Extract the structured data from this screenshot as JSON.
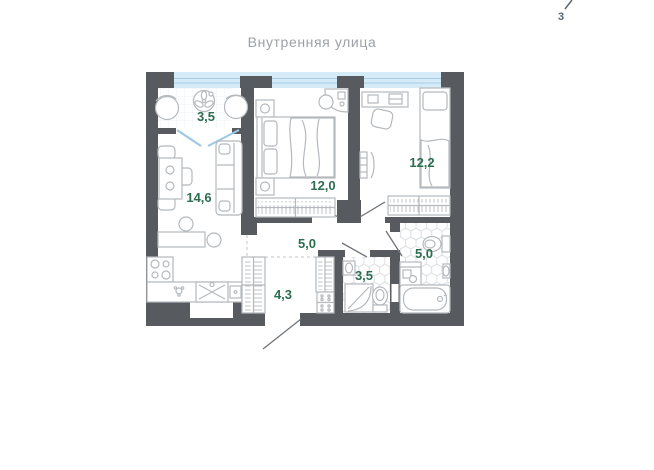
{
  "header": {
    "street_label": "Внутренняя улица"
  },
  "compass": {
    "north_label": "3"
  },
  "rooms": {
    "loggia": "3,5",
    "living_kitchen": "14,6",
    "bedroom_1": "12,0",
    "bedroom_2": "12,2",
    "corridor": "5,0",
    "bathroom_small": "3,5",
    "bathroom_large": "5,0",
    "hallway": "4,3"
  },
  "colors": {
    "wall": "#575b5f",
    "furniture_outline": "#b5b9bd",
    "window_fill": "#d6ebf8",
    "window_glass_line": "#a8cde6",
    "area_label_green": "#2c6e4f",
    "street_label_gray": "#9ba1a7",
    "tile_line": "#dfe2e4"
  }
}
